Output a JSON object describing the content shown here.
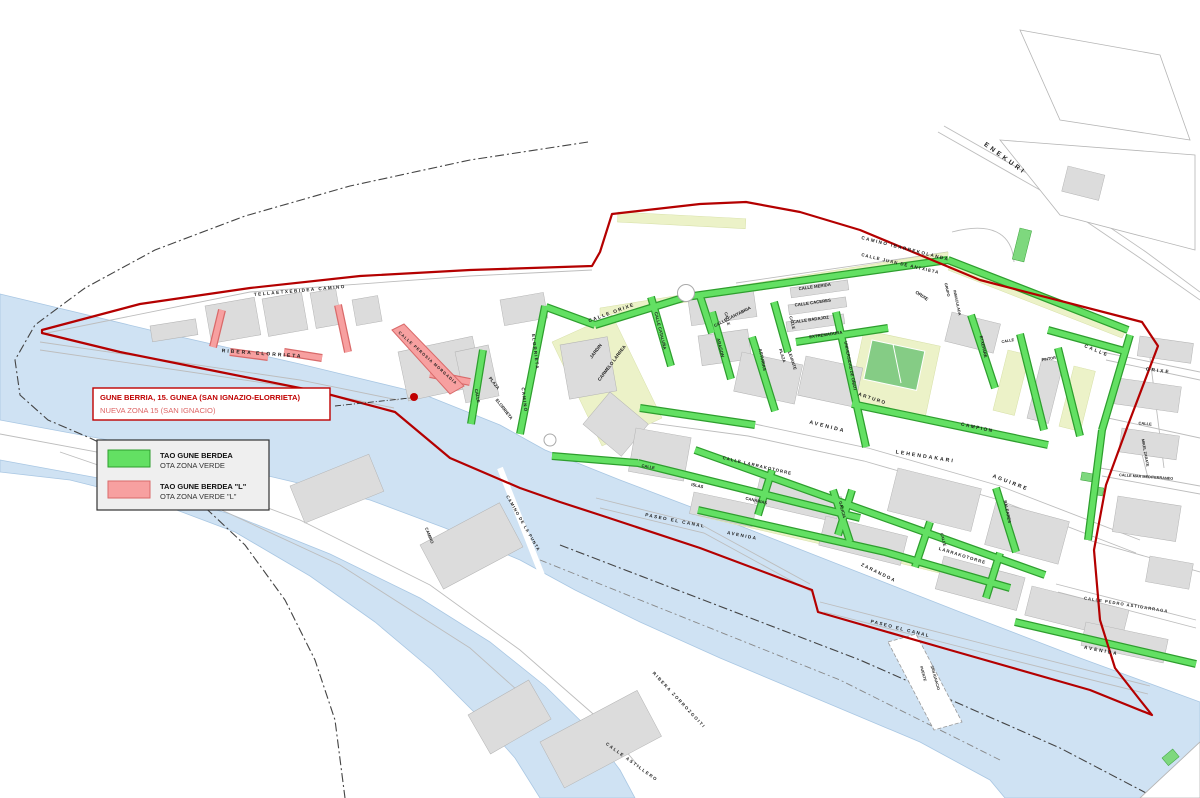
{
  "callout": {
    "line1": "GUNE BERRIA, 15. GUNEA (SAN IGNAZIO-ELORRIETA)",
    "line2": "NUEVA ZONA 15 (SAN IGNACIO)"
  },
  "legend": {
    "items": [
      {
        "swatch": "green",
        "line1": "TAO GUNE BERDEA",
        "line2": "OTA ZONA VERDE"
      },
      {
        "swatch": "red",
        "line1": "TAO GUNE BERDEA \"L\"",
        "line2": "OTA ZONA VERDE \"L\""
      }
    ]
  },
  "colors": {
    "green_zone": "#63e063",
    "green_border": "#2e9e2e",
    "red_l_zone": "#f7a0a0",
    "red_l_border": "#d96a6a",
    "zone_boundary_red": "#b40000",
    "water_blue": "#cfe2f3",
    "callout_red": "#c00000"
  },
  "labels": [
    {
      "t": "ENEKURI",
      "x": 1004,
      "y": 160,
      "r": 36,
      "s": 6.5,
      "ls": 3
    },
    {
      "t": "TELLAETXEBIDEA   CAMINO",
      "x": 300,
      "y": 292,
      "r": -5,
      "s": 4.6,
      "ls": 1.5
    },
    {
      "t": "RIBERA   ELORRIETA",
      "x": 262,
      "y": 355,
      "r": 4,
      "s": 5,
      "ls": 2
    },
    {
      "t": "CALLE PEROSIA MORGADIA",
      "x": 427,
      "y": 359,
      "r": 42,
      "s": 4,
      "ls": 1
    },
    {
      "t": "ELORRIETA",
      "x": 534,
      "y": 352,
      "r": 83,
      "s": 4.4,
      "ls": 1.2
    },
    {
      "t": "CAMINO",
      "x": 523,
      "y": 400,
      "r": 83,
      "s": 4.4,
      "ls": 1.2
    },
    {
      "t": "PLAZA",
      "x": 493,
      "y": 384,
      "r": 52,
      "s": 4.4
    },
    {
      "t": "ELORRIETA",
      "x": 503,
      "y": 410,
      "r": 52,
      "s": 4.4
    },
    {
      "t": "CALLE",
      "x": 476,
      "y": 396,
      "r": 80,
      "s": 4.2
    },
    {
      "t": "JARDIN",
      "x": 597,
      "y": 352,
      "r": -53,
      "s": 4.6
    },
    {
      "t": "CARMELO  LARREA",
      "x": 613,
      "y": 364,
      "r": -53,
      "s": 4.6
    },
    {
      "t": "CALLE   ORIXE",
      "x": 612,
      "y": 314,
      "r": -20,
      "s": 4.8,
      "ls": 1.5
    },
    {
      "t": "ORIXE",
      "x": 921,
      "y": 297,
      "r": 33,
      "s": 4.6
    },
    {
      "t": "ORIXE",
      "x": 1158,
      "y": 372,
      "r": 7,
      "s": 4.8,
      "ls": 2
    },
    {
      "t": "CAMINO   IBARREKOLANDA",
      "x": 905,
      "y": 250,
      "r": 14,
      "s": 4.6,
      "ls": 1.5
    },
    {
      "t": "CALLE  JUAN  DE  ANTXIETA",
      "x": 900,
      "y": 265,
      "r": 13,
      "s": 4.4,
      "ls": 1
    },
    {
      "t": "CALLE  MERIDA",
      "x": 815,
      "y": 288,
      "r": -8,
      "s": 4.3
    },
    {
      "t": "CALLE  CACERES",
      "x": 813,
      "y": 304,
      "r": -8,
      "s": 4.3
    },
    {
      "t": "CALLE  BADAJOZ",
      "x": 811,
      "y": 321,
      "r": -8,
      "s": 4.3
    },
    {
      "t": "CALLE",
      "x": 791,
      "y": 323,
      "r": 75,
      "s": 4
    },
    {
      "t": "EXTREMADURA",
      "x": 826,
      "y": 336,
      "r": -8,
      "s": 4.3
    },
    {
      "t": "PLAZA",
      "x": 781,
      "y": 356,
      "r": 72,
      "s": 4.2
    },
    {
      "t": "LEVANTE",
      "x": 791,
      "y": 361,
      "r": 72,
      "s": 4.2
    },
    {
      "t": "ASTURIAS",
      "x": 761,
      "y": 360,
      "r": 78,
      "s": 4.4
    },
    {
      "t": "CALLE  CANTABRIA",
      "x": 733,
      "y": 318,
      "r": -27,
      "s": 4.3
    },
    {
      "t": "CALLE  CATALUÑA",
      "x": 659,
      "y": 331,
      "r": 76,
      "s": 4.3
    },
    {
      "t": "CALLE",
      "x": 726,
      "y": 319,
      "r": 76,
      "s": 4
    },
    {
      "t": "ARAGON",
      "x": 719,
      "y": 348,
      "r": 76,
      "s": 4.4
    },
    {
      "t": "UNIVERSIDAD  DE  OÑATI",
      "x": 849,
      "y": 366,
      "r": 79,
      "s": 4.2
    },
    {
      "t": "GRUPO",
      "x": 946,
      "y": 290,
      "r": 78,
      "s": 3.8
    },
    {
      "t": "INMACULADA",
      "x": 956,
      "y": 303,
      "r": 78,
      "s": 3.8
    },
    {
      "t": "ETXEPARE",
      "x": 982,
      "y": 347,
      "r": 78,
      "s": 4.2
    },
    {
      "t": "CALLE",
      "x": 1008,
      "y": 342,
      "r": -10,
      "s": 3.8
    },
    {
      "t": "PINTOR",
      "x": 1049,
      "y": 360,
      "r": -10,
      "s": 3.8
    },
    {
      "t": "CALLE",
      "x": 1096,
      "y": 352,
      "r": 22,
      "s": 4.8,
      "ls": 2
    },
    {
      "t": "ARTURO",
      "x": 872,
      "y": 400,
      "r": 18,
      "s": 4.8,
      "ls": 1.5
    },
    {
      "t": "CAMPION",
      "x": 977,
      "y": 429,
      "r": 12,
      "s": 4.8,
      "ls": 1.5
    },
    {
      "t": "AVENIDA",
      "x": 827,
      "y": 428,
      "r": 14,
      "s": 5.2,
      "ls": 2
    },
    {
      "t": "LEHENDAKARI",
      "x": 925,
      "y": 458,
      "r": 9,
      "s": 5.2,
      "ls": 2
    },
    {
      "t": "AGUIRRE",
      "x": 1010,
      "y": 484,
      "r": 21,
      "s": 5.2,
      "ls": 2
    },
    {
      "t": "BALEARES",
      "x": 1006,
      "y": 512,
      "r": 78,
      "s": 4.2
    },
    {
      "t": "GALICIA",
      "x": 841,
      "y": 510,
      "r": 76,
      "s": 4.2
    },
    {
      "t": "CALLE   LARRAKOTORRE",
      "x": 757,
      "y": 467,
      "r": 13,
      "s": 4.4,
      "ls": 1
    },
    {
      "t": "CALLE",
      "x": 942,
      "y": 540,
      "r": 75,
      "s": 4
    },
    {
      "t": "LARRAKOTORRE",
      "x": 962,
      "y": 557,
      "r": 17,
      "s": 4.4,
      "ls": 1
    },
    {
      "t": "CALLE",
      "x": 648,
      "y": 468,
      "r": 10,
      "s": 4
    },
    {
      "t": "ISLAS",
      "x": 697,
      "y": 487,
      "r": 12,
      "s": 4.2
    },
    {
      "t": "CANARIAS",
      "x": 756,
      "y": 502,
      "r": 13,
      "s": 4.2
    },
    {
      "t": "PASEO  EL  CANAL",
      "x": 675,
      "y": 522,
      "r": 11,
      "s": 4.6,
      "ls": 1.5
    },
    {
      "t": "AVENIDA",
      "x": 742,
      "y": 537,
      "r": 11,
      "s": 4.6,
      "ls": 1.5
    },
    {
      "t": "ZARANDOA",
      "x": 878,
      "y": 574,
      "r": 26,
      "s": 4.6,
      "ls": 1.5
    },
    {
      "t": "PASEO  EL  CANAL",
      "x": 900,
      "y": 630,
      "r": 14,
      "s": 4.6,
      "ls": 1.5
    },
    {
      "t": "CALLE  PEDRO  ASTIGARRAGA",
      "x": 1126,
      "y": 606,
      "r": 9,
      "s": 4.2,
      "ls": 1
    },
    {
      "t": "AVENIDA",
      "x": 1101,
      "y": 652,
      "r": 11,
      "s": 4.8,
      "ls": 2
    },
    {
      "t": "RIBERA  ZORROZGOITI",
      "x": 678,
      "y": 701,
      "r": 47,
      "s": 4.4,
      "ls": 1.5
    },
    {
      "t": "CALLE  ASTILLERO",
      "x": 631,
      "y": 763,
      "r": 36,
      "s": 4.4,
      "ls": 1.5
    },
    {
      "t": "CAMINO  DE  LA  PUNTA",
      "x": 522,
      "y": 524,
      "r": 60,
      "s": 4.2,
      "ls": 1
    },
    {
      "t": "CAMINO",
      "x": 428,
      "y": 536,
      "r": 68,
      "s": 4.2
    },
    {
      "t": "PUENTE",
      "x": 922,
      "y": 674,
      "r": 74,
      "s": 3.8
    },
    {
      "t": "SAN  IGNACIO",
      "x": 934,
      "y": 678,
      "r": 74,
      "s": 3.8
    },
    {
      "t": "MIKEL  ZARATE",
      "x": 1144,
      "y": 453,
      "r": 80,
      "s": 3.8
    },
    {
      "t": "CALLE  MAR  MEDITERRANEO",
      "x": 1146,
      "y": 478,
      "r": 4,
      "s": 3.8
    },
    {
      "t": "CALLE",
      "x": 1145,
      "y": 425,
      "r": 5,
      "s": 4
    }
  ]
}
